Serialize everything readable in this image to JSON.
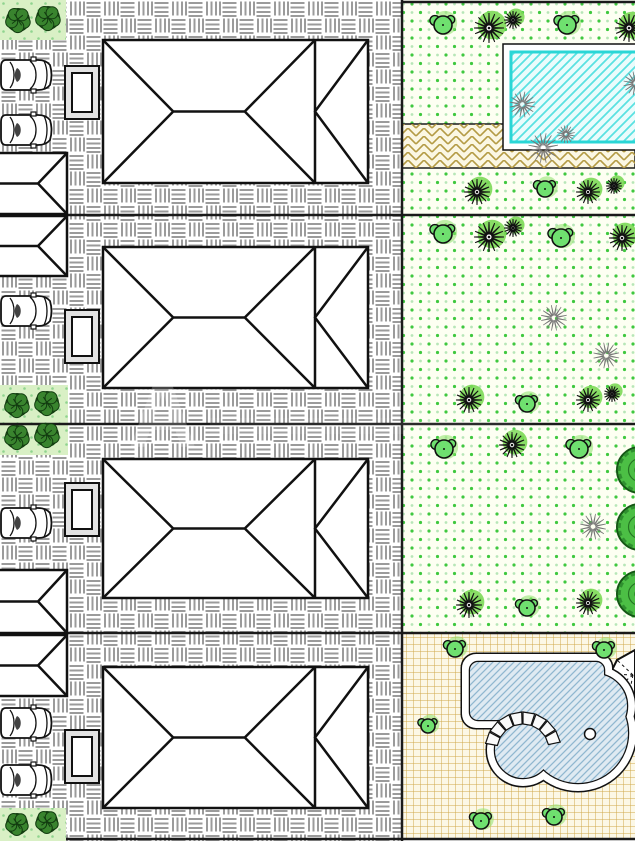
{
  "title": "landscape-architecture-site-plan",
  "canvas": {
    "width": 635,
    "height": 849,
    "drawing_bottom": 841
  },
  "watermark": {
    "letter": "A"
  },
  "colors": {
    "outline": "#111111",
    "boundary": "#1a1a1a",
    "paving_line": "#9b9b9b",
    "lawn_bg": "#fdfff2",
    "lawn_dot": "#3fc83f",
    "lawn_dot_pale": "#b7e6b7",
    "bed_bg": "#d9f0c5",
    "bed_dot": "#8fd48f",
    "shrub_fill": "#6fe06f",
    "shrub_halo": "#8ee26a",
    "dark_shrub": "#39842e",
    "dark_shrub_line": "#123c10",
    "spiky_halo": "#7cd957",
    "leafy_fill": "#4cbf45",
    "leafy_line": "#155715",
    "pool_border": "#2ad6d6",
    "pool_hatch": "#5ae2e2",
    "pool_bg": "#eafcfc",
    "pool2_bg": "#dfeaf2",
    "pool2_hatch": "#90b7d0",
    "tan_line": "#b49b45",
    "strip_bg": "#fbf7e3",
    "grid_line": "#cfa94a",
    "grid_bg": "#fcf8e6",
    "planter_band": "#e3e3e3",
    "house_fill": "#ffffff"
  },
  "zones": {
    "paving": [
      0,
      0,
      402,
      841
    ],
    "lawns": [
      [
        402,
        0,
        233,
        215
      ],
      [
        402,
        215,
        233,
        209
      ],
      [
        402,
        424,
        233,
        209
      ]
    ],
    "grid_lot": [
      402,
      633,
      233,
      206
    ],
    "paved_strip": [
      402,
      124,
      233,
      44
    ]
  },
  "boundaries": {
    "vertical": {
      "x": 402,
      "y1": 0,
      "y2": 841
    },
    "horizontal": [
      {
        "x1": 402,
        "y": 2,
        "x2": 635
      },
      {
        "x1": 0,
        "y": 215,
        "x2": 635
      },
      {
        "x1": 0,
        "y": 424,
        "x2": 635
      },
      {
        "x1": 0,
        "y": 633,
        "x2": 635
      },
      {
        "x1": 66,
        "y": 839,
        "x2": 635
      }
    ]
  },
  "houses_big": [
    {
      "x": 103,
      "y": 40,
      "w": 265,
      "h": 143
    },
    {
      "x": 103,
      "y": 247,
      "w": 265,
      "h": 141
    },
    {
      "x": 103,
      "y": 459,
      "w": 265,
      "h": 139
    },
    {
      "x": 103,
      "y": 667,
      "w": 265,
      "h": 141
    }
  ],
  "houses_big_geometry": {
    "apex_fx": 0.265,
    "ridge_fx": 0.535,
    "vline_fx": 0.8
  },
  "houses_left": {
    "x": -8,
    "w": 75,
    "apex_x": 38,
    "rows": [
      {
        "y": 153,
        "h": 61
      },
      {
        "y": 216,
        "h": 60
      },
      {
        "y": 570,
        "h": 63
      },
      {
        "y": 635,
        "h": 61
      }
    ]
  },
  "cars": {
    "x": 0,
    "w": 52,
    "h": 36,
    "rows_y": [
      57,
      112,
      293,
      505,
      705,
      762
    ]
  },
  "planters": {
    "x": 65,
    "w": 34,
    "h": 53,
    "inset": 7,
    "rows_y": [
      66,
      310,
      483,
      730
    ]
  },
  "beds": [
    {
      "rect": [
        0,
        0,
        66,
        40
      ],
      "shrubs": [
        [
          18,
          20,
          12
        ],
        [
          48,
          18,
          12
        ]
      ]
    },
    {
      "rect": [
        0,
        385,
        68,
        70
      ],
      "shrubs": [
        [
          17,
          405,
          12
        ],
        [
          47,
          403,
          12
        ],
        [
          17,
          437,
          12
        ],
        [
          47,
          435,
          12
        ]
      ]
    },
    {
      "rect": [
        0,
        808,
        66,
        33
      ],
      "shrubs": [
        [
          17,
          824,
          11
        ],
        [
          47,
          822,
          11
        ]
      ]
    }
  ],
  "trees": {
    "shrub_clusters": [
      [
        443,
        25,
        9
      ],
      [
        567,
        25,
        9
      ],
      [
        545,
        189,
        8
      ],
      [
        443,
        234,
        9
      ],
      [
        561,
        238,
        9
      ],
      [
        527,
        404,
        8
      ],
      [
        444,
        449,
        9
      ],
      [
        579,
        449,
        9
      ],
      [
        527,
        608,
        8
      ],
      [
        455,
        649,
        8
      ],
      [
        604,
        650,
        8
      ],
      [
        428,
        726,
        7
      ],
      [
        481,
        821,
        8
      ],
      [
        554,
        817,
        8
      ]
    ],
    "spiky": [
      [
        489,
        28,
        15
      ],
      [
        513,
        20,
        9
      ],
      [
        629,
        28,
        14
      ],
      [
        477,
        192,
        13
      ],
      [
        588,
        192,
        12
      ],
      [
        614,
        186,
        8
      ],
      [
        489,
        237,
        15
      ],
      [
        513,
        228,
        9
      ],
      [
        622,
        238,
        13
      ],
      [
        469,
        400,
        13
      ],
      [
        588,
        400,
        12
      ],
      [
        612,
        394,
        8
      ],
      [
        512,
        445,
        13
      ],
      [
        469,
        605,
        13
      ],
      [
        588,
        603,
        12
      ]
    ],
    "leafy": [
      [
        640,
        470,
        23
      ],
      [
        640,
        527,
        23
      ],
      [
        640,
        594,
        23
      ]
    ]
  },
  "pool_top": {
    "deck": [
      503,
      44,
      140,
      106
    ],
    "inner": [
      511,
      52,
      132,
      90
    ]
  },
  "pool_bottom": {
    "deck_shapes": {
      "rect": [
        462,
        654,
        150,
        74,
        14
      ],
      "circle_corner": [
        595,
        706,
        40
      ],
      "circle_main": [
        578,
        733,
        58
      ],
      "circle_spa": [
        523,
        750,
        36
      ]
    },
    "inner_shapes": {
      "rect": [
        470,
        662,
        134,
        58,
        8
      ],
      "circle_corner": [
        595,
        706,
        32
      ],
      "circle_main": [
        578,
        733,
        50
      ],
      "circle_spa": [
        523,
        750,
        28
      ]
    },
    "stones": {
      "cx": 523,
      "cy": 750,
      "r1": 26,
      "r2": 38,
      "start": 190,
      "end": 350,
      "step": 20
    },
    "drain": [
      590,
      734,
      5.5
    ]
  },
  "gazebo": {
    "points": [
      [
        635,
        650
      ],
      [
        617,
        660
      ],
      [
        610,
        674
      ],
      [
        615,
        689
      ],
      [
        628,
        699
      ],
      [
        635,
        701
      ]
    ],
    "hub": [
      633,
      675
    ]
  }
}
